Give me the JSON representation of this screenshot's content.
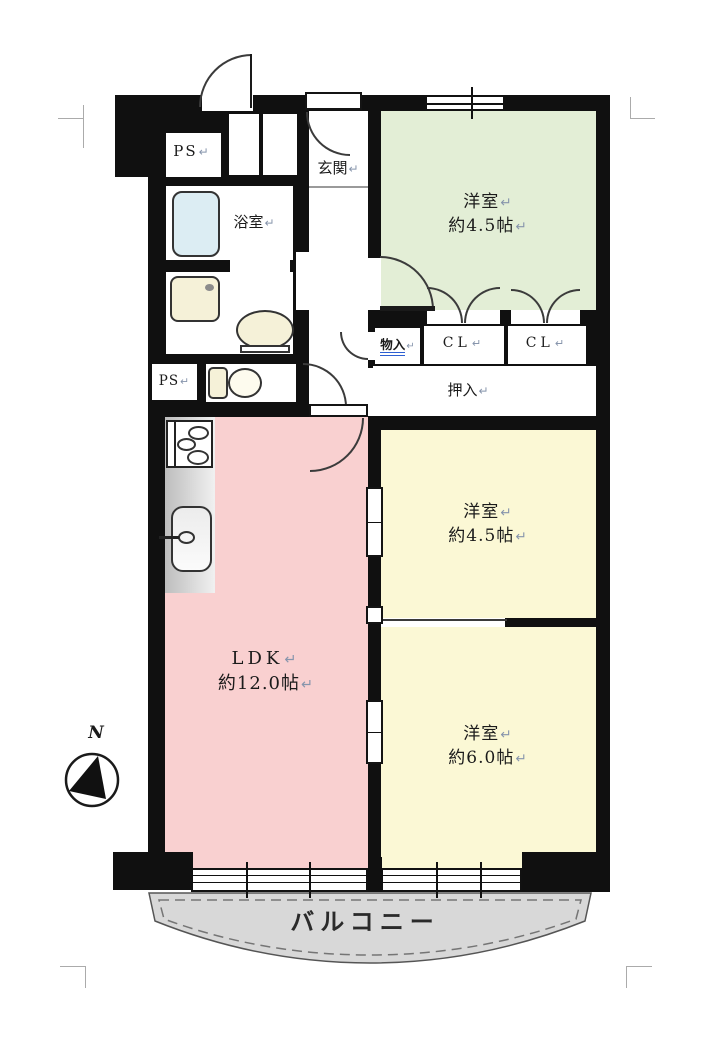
{
  "rooms": {
    "ps_top": {
      "text": "PS",
      "mark": "↵"
    },
    "genkan": {
      "text": "玄関",
      "mark": "↵"
    },
    "bath": {
      "text": "浴室",
      "mark": "↵"
    },
    "western_green": {
      "name": "洋室",
      "name_mark": "↵",
      "size": "約4.5帖",
      "size_mark": "↵"
    },
    "monoire": {
      "text": "物入",
      "mark": "↵"
    },
    "cl_left": {
      "text": "CL",
      "mark": "↵"
    },
    "cl_right": {
      "text": "CL",
      "mark": "↵"
    },
    "oshiire": {
      "text": "押入",
      "mark": "↵"
    },
    "ps_lower": {
      "text": "PS",
      "mark": "↵"
    },
    "western_mid": {
      "name": "洋室",
      "name_mark": "↵",
      "size": "約4.5帖",
      "size_mark": "↵"
    },
    "ldk": {
      "name": "LDK",
      "name_mark": "↵",
      "size": "約12.0帖",
      "size_mark": "↵"
    },
    "western_bottom": {
      "name": "洋室",
      "name_mark": "↵",
      "size": "約6.0帖",
      "size_mark": "↵"
    },
    "balcony": {
      "text": "バルコニー"
    }
  },
  "compass": {
    "label": "N"
  },
  "colors": {
    "wall": "#101010",
    "room_green": "#e3eed6",
    "room_yellow": "#fbf8d5",
    "room_pink": "#f9d0d0",
    "balcony_gray": "#d8d8d8",
    "bathtub_blue": "#dcedf3",
    "fixture_cream": "#f5f1d8"
  }
}
